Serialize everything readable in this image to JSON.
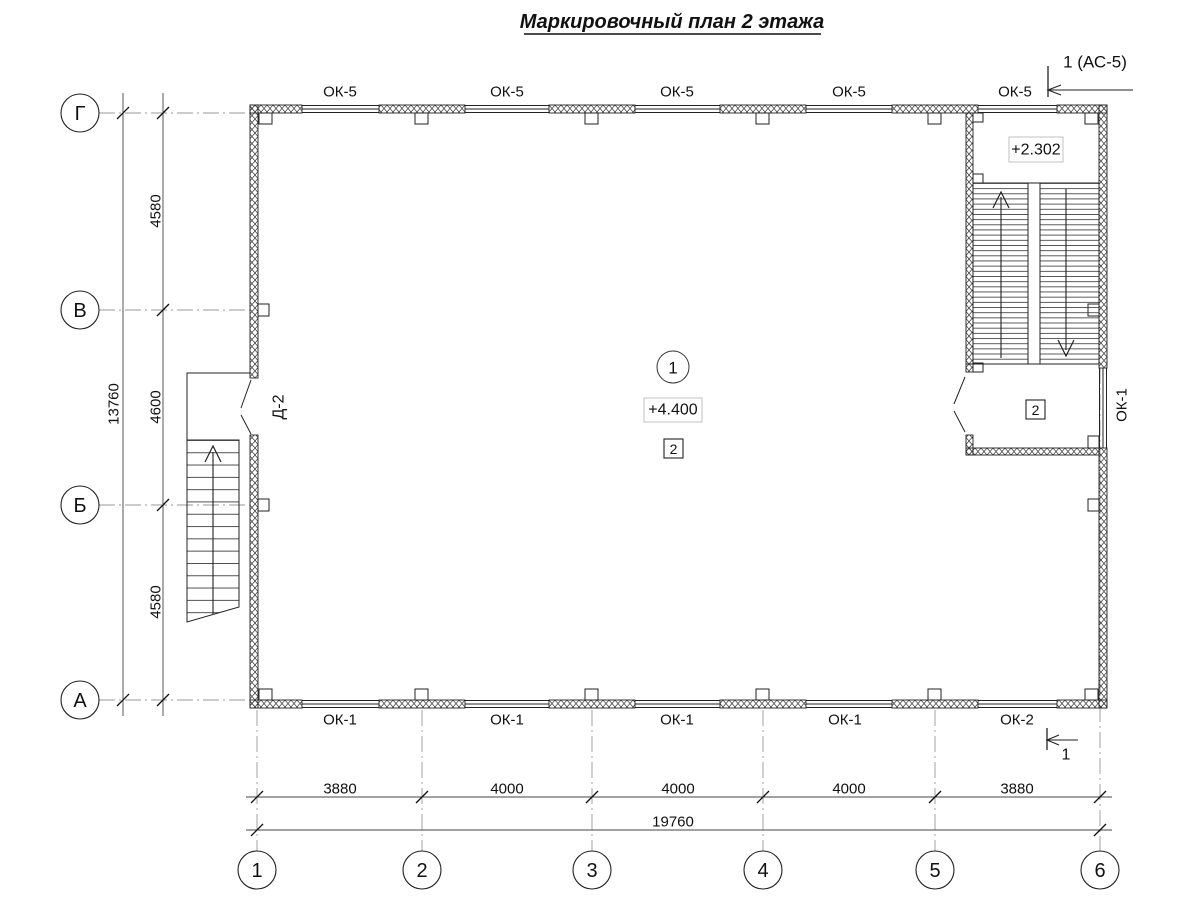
{
  "title": "Маркировочный план 2 этажа",
  "section_marks": {
    "top": "1 (АС-5)",
    "bottom": "1"
  },
  "axes": {
    "rows": [
      "Г",
      "В",
      "Б",
      "А"
    ],
    "cols": [
      "1",
      "2",
      "3",
      "4",
      "5",
      "6"
    ]
  },
  "dimensions": {
    "vertical": {
      "segments": [
        "4580",
        "4600",
        "4580"
      ],
      "total": "13760"
    },
    "horizontal": {
      "segments": [
        "3880",
        "4000",
        "4000",
        "4000",
        "3880"
      ],
      "total": "19760"
    }
  },
  "windows": {
    "top": [
      "ОК-5",
      "ОК-5",
      "ОК-5",
      "ОК-5",
      "ОК-5"
    ],
    "bottom": [
      "ОК-1",
      "ОК-1",
      "ОК-1",
      "ОК-1",
      "ОК-2"
    ],
    "right": "ОК-1"
  },
  "doors": {
    "left": "Д-2"
  },
  "elevations": {
    "main": "+4.400",
    "stair_landing": "+2.302"
  },
  "rooms": {
    "hall_number": "1",
    "hall_type": "2",
    "stair_room_type": "2"
  },
  "colors": {
    "line": "#222222",
    "axis_line": "#999999",
    "dim_line": "#333333",
    "background": "#ffffff"
  }
}
